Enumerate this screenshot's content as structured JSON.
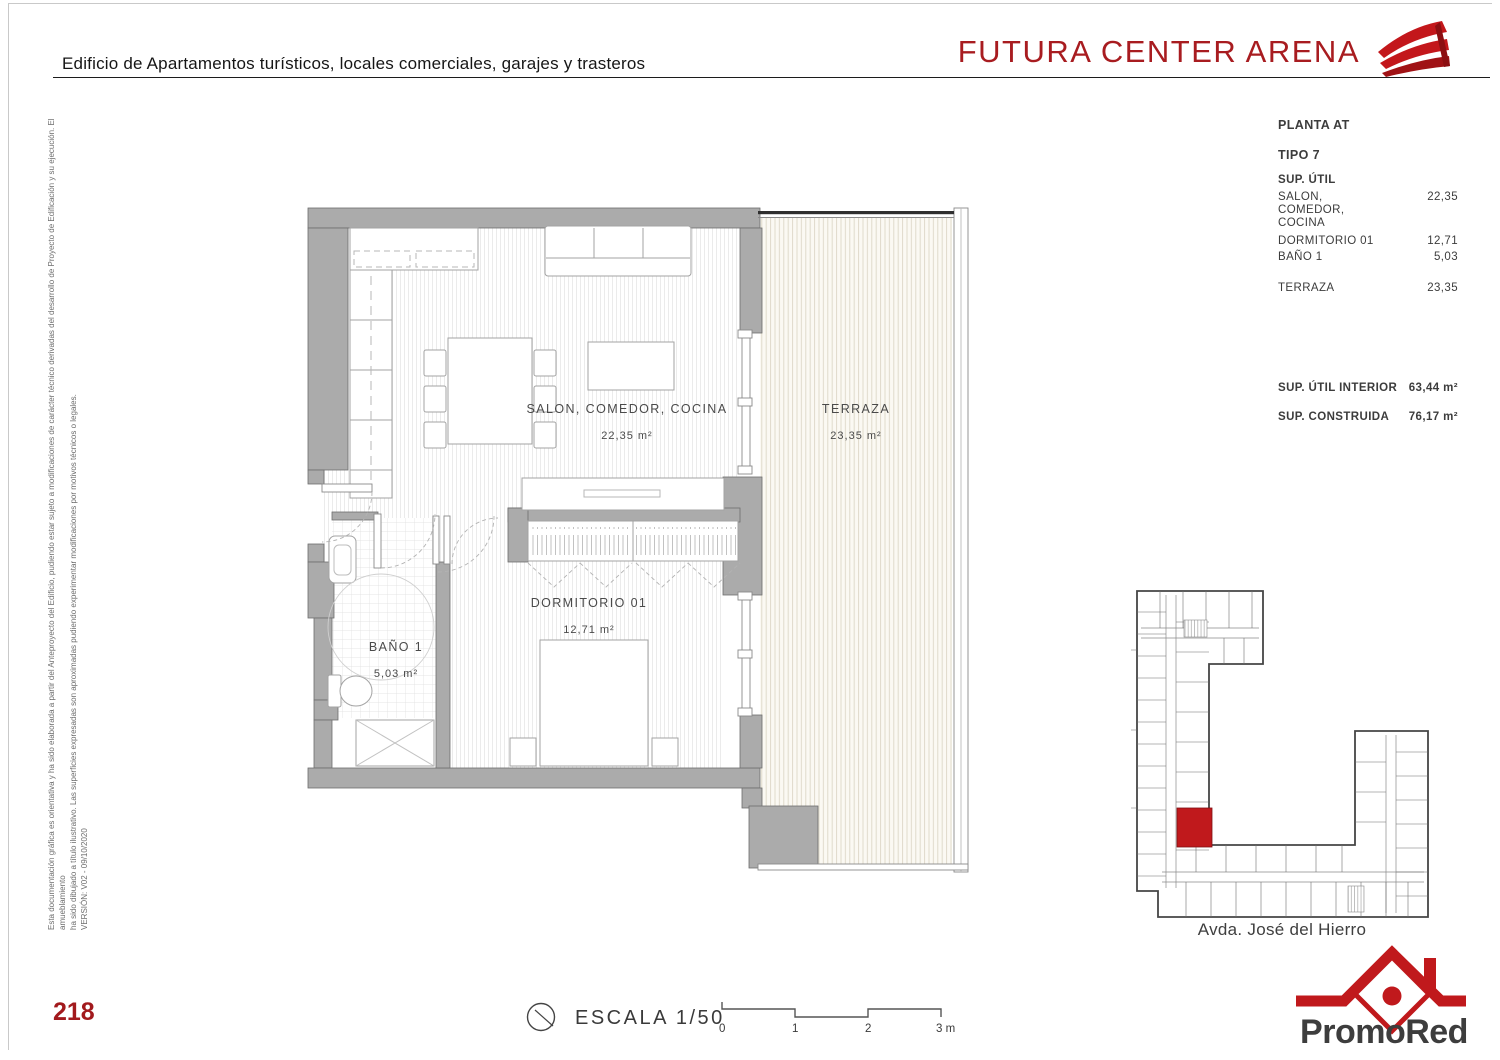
{
  "header": {
    "subtitle": "Edificio de Apartamentos turísticos, locales comerciales, garajes y trasteros",
    "title": "FUTURA CENTER ARENA"
  },
  "info_panel": {
    "planta": "PLANTA AT",
    "tipo": "TIPO 7",
    "sup_util_label": "SUP. ÚTIL",
    "salon": {
      "line1": "SALON,",
      "line2": "COMEDOR,",
      "line3": "COCINA",
      "value": "22,35"
    },
    "dormitorio": {
      "label": "DORMITORIO 01",
      "value": "12,71"
    },
    "bano": {
      "label": "BAÑO 1",
      "value": "5,03"
    },
    "terraza": {
      "label": "TERRAZA",
      "value": "23,35"
    },
    "sup_util_interior": {
      "label": "SUP. ÚTIL INTERIOR",
      "value": "63,44 m²"
    },
    "sup_construida": {
      "label": "SUP. CONSTRUIDA",
      "value": "76,17 m²"
    }
  },
  "plan": {
    "salon": {
      "name": "SALON, COMEDOR, COCINA",
      "area": "22,35 m²"
    },
    "terraza": {
      "name": "TERRAZA",
      "area": "23,35 m²"
    },
    "dormitorio": {
      "name": "DORMITORIO 01",
      "area": "12,71 m²"
    },
    "bano": {
      "name": "BAÑO 1",
      "area": "5,03 m²"
    }
  },
  "key_plan": {
    "street_label": "Avda. José del Hierro"
  },
  "footer": {
    "page_number": "218",
    "scale_label": "ESCALA 1/50",
    "scale_ticks": [
      "0",
      "1",
      "2",
      "3 m"
    ]
  },
  "disclaimer": {
    "line1": "Esta documentación gráfica es orientativa y ha sido elaborada a partir del Anteproyecto del Edificio, pudiendo estar sujeto a modificaciones de carácter técnico derivadas del desarrollo de Proyecto de Edificación y su ejecución. El amueblamiento",
    "line2": "ha sido dibujado a título ilustrativo. Las superficies expresadas son aproximadas pudiendo experimentar modificaciones por motivos técnicos o legales.",
    "version": "VERSIÓN: V02 - 09/10/2020"
  },
  "branding": {
    "promored": "PromoRed"
  },
  "colors": {
    "brand_red": "#a81c20",
    "accent_red": "#c0191c",
    "wall_gray": "#ababab"
  }
}
